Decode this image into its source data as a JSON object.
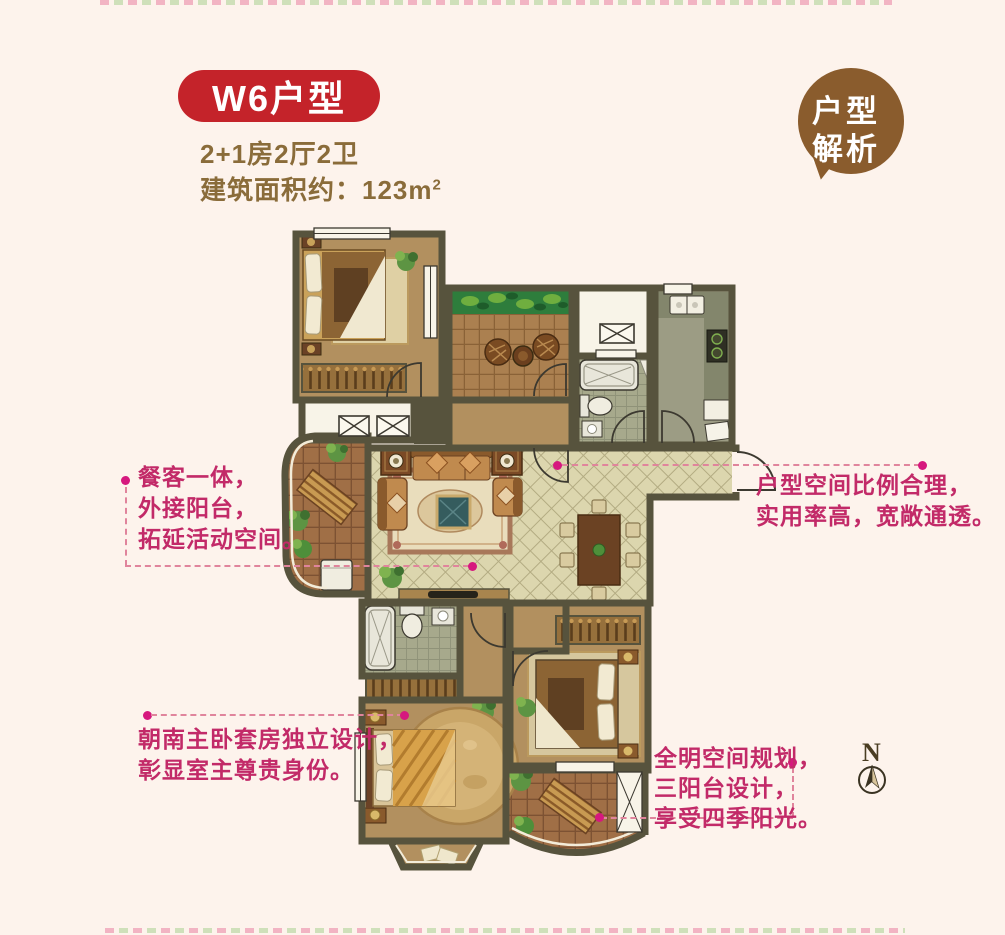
{
  "header": {
    "title": "W6户型",
    "subtitle": "2+1房2厅2卫",
    "area_label": "建筑面积约：",
    "area_value": "123m",
    "area_sup": "2",
    "badge_color": "#c4232a",
    "text_color": "#8a6c3a"
  },
  "callout_bubble": {
    "line1": "户型",
    "line2": "解析",
    "color": "#8a5c2d"
  },
  "annotations": [
    {
      "id": "dining-balcony",
      "lines": [
        "餐客一体，",
        "外接阳台，",
        "拓延活动空间。"
      ]
    },
    {
      "id": "layout-ratio",
      "lines": [
        "户型空间比例合理，",
        "实用率高，宽敞通透。"
      ]
    },
    {
      "id": "master-suite",
      "lines": [
        "朝南主卧套房独立设计，",
        "彰显室主尊贵身份。"
      ]
    },
    {
      "id": "three-balconies",
      "lines": [
        "全明空间规划，",
        "三阳台设计，",
        "享受四季阳光。"
      ]
    }
  ],
  "compass": {
    "label": "N"
  },
  "colors": {
    "background": "#fdf3ec",
    "annotation_text": "#c22a68",
    "connector_dash": "#e0849c",
    "connector_dot": "#d6187e",
    "wall": "#57533d",
    "floor_tan": "#b2905f",
    "floor_cream_tile": "#dcd6ae",
    "floor_brown_tile": "#a06f46",
    "floor_bath_tile": "#a7a98c",
    "planter_green": "#2e7d3c"
  }
}
